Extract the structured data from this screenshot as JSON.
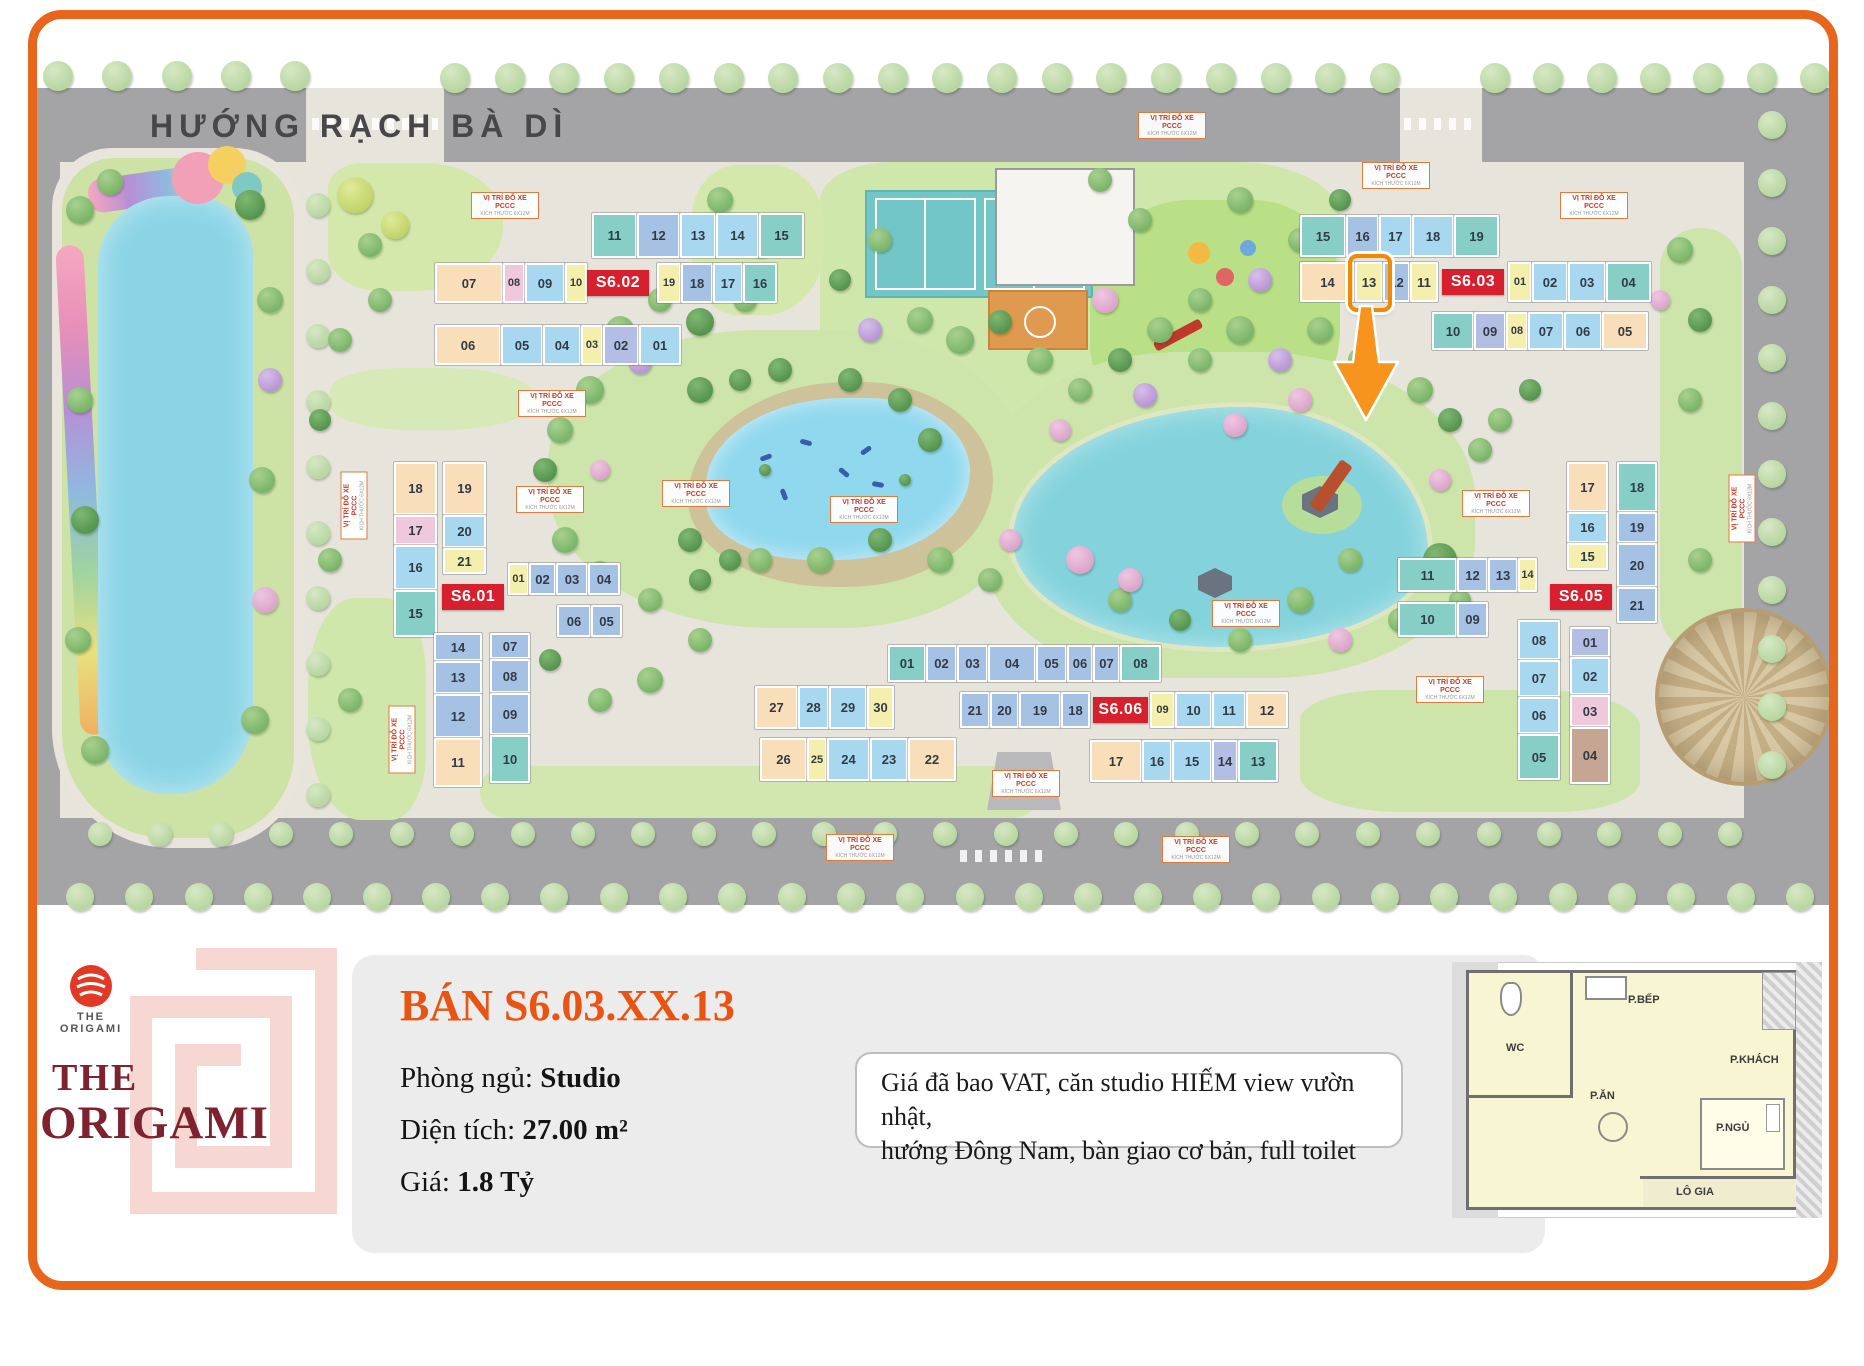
{
  "map": {
    "road_title": "HƯỚNG RẠCH BÀ DÌ",
    "pccc_label": "VỊ TRÍ ĐỖ XE PCCC",
    "pccc_sub": "KÍCH THƯỚC 6X12M",
    "unit_colors": {
      "t": "#87CFC6",
      "s": "#A8D8F0",
      "b": "#A5C1E4",
      "y": "#F5EFAD",
      "p": "#F8DFB9",
      "k": "#EFC8DB",
      "v": "#B2BEE3",
      "n": "#C7A593"
    },
    "highlight": {
      "building": "S6.03",
      "unit": "13"
    },
    "buildings": [
      {
        "label": "S6.02",
        "strips": [
          {
            "x": 592,
            "y": 213,
            "dir": "h",
            "h": 45,
            "cells": [
              {
                "n": "11",
                "c": "t",
                "w": 45
              },
              {
                "n": "12",
                "c": "b",
                "w": 43
              },
              {
                "n": "13",
                "c": "s",
                "w": 36
              },
              {
                "n": "14",
                "c": "s",
                "w": 43
              },
              {
                "n": "15",
                "c": "t",
                "w": 45
              }
            ]
          },
          {
            "x": 435,
            "y": 263,
            "dir": "h",
            "h": 40,
            "cells": [
              {
                "n": "07",
                "c": "p",
                "w": 68
              },
              {
                "n": "08",
                "c": "k",
                "w": 22
              },
              {
                "n": "09",
                "c": "s",
                "w": 40
              },
              {
                "n": "10",
                "c": "y",
                "w": 22
              },
              {
                "lab": true,
                "w": 62
              },
              {
                "n": "19",
                "c": "y",
                "w": 24,
                "g": 8
              },
              {
                "n": "18",
                "c": "b",
                "w": 32
              },
              {
                "n": "17",
                "c": "s",
                "w": 30
              },
              {
                "n": "16",
                "c": "t",
                "w": 34
              }
            ]
          },
          {
            "x": 435,
            "y": 325,
            "dir": "h",
            "h": 40,
            "cells": [
              {
                "n": "06",
                "c": "p",
                "w": 66
              },
              {
                "n": "05",
                "c": "s",
                "w": 42
              },
              {
                "n": "04",
                "c": "s",
                "w": 38
              },
              {
                "n": "03",
                "c": "y",
                "w": 22
              },
              {
                "n": "02",
                "c": "v",
                "w": 36
              },
              {
                "n": "01",
                "c": "s",
                "w": 42
              }
            ]
          }
        ]
      },
      {
        "label": "S6.03",
        "strips": [
          {
            "x": 1300,
            "y": 215,
            "dir": "h",
            "h": 42,
            "cells": [
              {
                "n": "15",
                "c": "t",
                "w": 46
              },
              {
                "n": "16",
                "c": "b",
                "w": 33
              },
              {
                "n": "17",
                "c": "s",
                "w": 33
              },
              {
                "n": "18",
                "c": "s",
                "w": 42
              },
              {
                "n": "19",
                "c": "t",
                "w": 45
              }
            ]
          },
          {
            "x": 1300,
            "y": 262,
            "dir": "h",
            "h": 40,
            "cells": [
              {
                "n": "14",
                "c": "p",
                "w": 55
              },
              {
                "n": "13",
                "c": "y",
                "w": 28,
                "hl": true
              },
              {
                "n": "12",
                "c": "b",
                "w": 27
              },
              {
                "n": "11",
                "c": "y",
                "w": 28
              },
              {
                "lab": true,
                "w": 62,
                "g": 4
              },
              {
                "n": "01",
                "c": "y",
                "w": 24,
                "g": 4
              },
              {
                "n": "02",
                "c": "s",
                "w": 36
              },
              {
                "n": "03",
                "c": "s",
                "w": 38
              },
              {
                "n": "04",
                "c": "t",
                "w": 45
              }
            ]
          },
          {
            "x": 1432,
            "y": 312,
            "dir": "h",
            "h": 38,
            "cells": [
              {
                "n": "10",
                "c": "t",
                "w": 42
              },
              {
                "n": "09",
                "c": "v",
                "w": 32
              },
              {
                "n": "08",
                "c": "y",
                "w": 22
              },
              {
                "n": "07",
                "c": "s",
                "w": 36
              },
              {
                "n": "06",
                "c": "s",
                "w": 38
              },
              {
                "n": "05",
                "c": "p",
                "w": 46
              }
            ]
          }
        ]
      },
      {
        "label": "S6.01",
        "strips": [
          {
            "x": 394,
            "y": 462,
            "dir": "v",
            "w": 43,
            "cells": [
              {
                "n": "18",
                "c": "p",
                "h": 53
              },
              {
                "n": "17",
                "c": "k",
                "h": 30
              },
              {
                "n": "16",
                "c": "s",
                "h": 45
              },
              {
                "n": "15",
                "c": "t",
                "h": 47
              }
            ]
          },
          {
            "x": 443,
            "y": 462,
            "dir": "v",
            "w": 43,
            "cells": [
              {
                "n": "19",
                "c": "p",
                "h": 53
              },
              {
                "n": "20",
                "c": "s",
                "h": 33
              },
              {
                "n": "21",
                "c": "y",
                "h": 26
              }
            ]
          },
          {
            "x": 442,
            "y": 584,
            "dir": "h",
            "h": 26,
            "cells": [
              {
                "lab": true,
                "w": 62
              }
            ]
          },
          {
            "x": 508,
            "y": 563,
            "dir": "h",
            "h": 32,
            "cells": [
              {
                "n": "01",
                "c": "y",
                "w": 21
              },
              {
                "n": "02",
                "c": "b",
                "w": 27
              },
              {
                "n": "03",
                "c": "b",
                "w": 32
              },
              {
                "n": "04",
                "c": "b",
                "w": 32
              }
            ]
          },
          {
            "x": 557,
            "y": 605,
            "dir": "h",
            "h": 32,
            "cells": [
              {
                "n": "06",
                "c": "b",
                "w": 34
              },
              {
                "n": "05",
                "c": "b",
                "w": 31
              }
            ]
          },
          {
            "x": 434,
            "y": 633,
            "dir": "v",
            "w": 48,
            "cells": [
              {
                "n": "14",
                "c": "b",
                "h": 28
              },
              {
                "n": "13",
                "c": "b",
                "h": 33
              },
              {
                "n": "12",
                "c": "b",
                "h": 44
              },
              {
                "n": "11",
                "c": "p",
                "h": 49
              }
            ]
          },
          {
            "x": 490,
            "y": 633,
            "dir": "v",
            "w": 40,
            "cells": [
              {
                "n": "07",
                "c": "b",
                "h": 26
              },
              {
                "n": "08",
                "c": "b",
                "h": 34
              },
              {
                "n": "09",
                "c": "b",
                "h": 42
              },
              {
                "n": "10",
                "c": "t",
                "h": 48
              }
            ]
          }
        ]
      },
      {
        "label": "S6.05",
        "strips": [
          {
            "x": 1398,
            "y": 558,
            "dir": "h",
            "h": 34,
            "cells": [
              {
                "n": "11",
                "c": "t",
                "w": 59
              },
              {
                "n": "12",
                "c": "b",
                "w": 31
              },
              {
                "n": "13",
                "c": "b",
                "w": 30
              },
              {
                "n": "14",
                "c": "y",
                "w": 19
              }
            ]
          },
          {
            "x": 1398,
            "y": 602,
            "dir": "h",
            "h": 35,
            "cells": [
              {
                "n": "10",
                "c": "t",
                "w": 59
              },
              {
                "n": "09",
                "c": "b",
                "w": 31
              }
            ]
          },
          {
            "x": 1567,
            "y": 462,
            "dir": "v",
            "w": 41,
            "cells": [
              {
                "n": "17",
                "c": "p",
                "h": 50
              },
              {
                "n": "16",
                "c": "s",
                "h": 31
              },
              {
                "n": "15",
                "c": "y",
                "h": 27
              }
            ]
          },
          {
            "x": 1617,
            "y": 462,
            "dir": "v",
            "w": 40,
            "cells": [
              {
                "n": "18",
                "c": "t",
                "h": 50
              },
              {
                "n": "19",
                "c": "b",
                "h": 31
              },
              {
                "n": "20",
                "c": "b",
                "h": 44
              },
              {
                "n": "21",
                "c": "b",
                "h": 36
              }
            ]
          },
          {
            "x": 1550,
            "y": 584,
            "dir": "h",
            "h": 26,
            "cells": [
              {
                "lab": true,
                "w": 62
              }
            ]
          },
          {
            "x": 1518,
            "y": 620,
            "dir": "v",
            "w": 42,
            "cells": [
              {
                "n": "08",
                "c": "s",
                "h": 40
              },
              {
                "n": "07",
                "c": "s",
                "h": 37
              },
              {
                "n": "06",
                "c": "s",
                "h": 37
              },
              {
                "n": "05",
                "c": "t",
                "h": 46
              }
            ]
          },
          {
            "x": 1570,
            "y": 627,
            "dir": "v",
            "w": 40,
            "cells": [
              {
                "n": "01",
                "c": "v",
                "h": 30
              },
              {
                "n": "02",
                "c": "s",
                "h": 38
              },
              {
                "n": "03",
                "c": "k",
                "h": 32
              },
              {
                "n": "04",
                "c": "n",
                "h": 57
              }
            ]
          }
        ]
      },
      {
        "label": "S6.06",
        "strips": [
          {
            "x": 888,
            "y": 645,
            "dir": "h",
            "h": 37,
            "cells": [
              {
                "n": "01",
                "c": "t",
                "w": 38
              },
              {
                "n": "02",
                "c": "b",
                "w": 31
              },
              {
                "n": "03",
                "c": "b",
                "w": 31
              },
              {
                "n": "04",
                "c": "b",
                "w": 48
              },
              {
                "n": "05",
                "c": "b",
                "w": 31
              },
              {
                "n": "06",
                "c": "b",
                "w": 26
              },
              {
                "n": "07",
                "c": "b",
                "w": 27
              },
              {
                "n": "08",
                "c": "t",
                "w": 41
              }
            ]
          },
          {
            "x": 755,
            "y": 686,
            "dir": "h",
            "h": 43,
            "cells": [
              {
                "n": "27",
                "c": "p",
                "w": 43
              },
              {
                "n": "28",
                "c": "s",
                "w": 31
              },
              {
                "n": "29",
                "c": "s",
                "w": 38
              },
              {
                "n": "30",
                "c": "y",
                "w": 27
              }
            ]
          },
          {
            "x": 960,
            "y": 692,
            "dir": "h",
            "h": 36,
            "cells": [
              {
                "n": "21",
                "c": "b",
                "w": 30
              },
              {
                "n": "20",
                "c": "b",
                "w": 29
              },
              {
                "n": "19",
                "c": "b",
                "w": 42
              },
              {
                "n": "18",
                "c": "b",
                "w": 29
              },
              {
                "lab": true,
                "w": 55,
                "g": 3
              },
              {
                "n": "09",
                "c": "y",
                "w": 25,
                "g": 2
              },
              {
                "n": "10",
                "c": "s",
                "w": 37
              },
              {
                "n": "11",
                "c": "s",
                "w": 34
              },
              {
                "n": "12",
                "c": "p",
                "w": 42
              }
            ]
          },
          {
            "x": 760,
            "y": 738,
            "dir": "h",
            "h": 43,
            "cells": [
              {
                "n": "26",
                "c": "p",
                "w": 47
              },
              {
                "n": "25",
                "c": "y",
                "w": 20
              },
              {
                "n": "24",
                "c": "s",
                "w": 43
              },
              {
                "n": "23",
                "c": "s",
                "w": 38
              },
              {
                "n": "22",
                "c": "p",
                "w": 48
              }
            ]
          },
          {
            "x": 1090,
            "y": 740,
            "dir": "h",
            "h": 42,
            "cells": [
              {
                "n": "17",
                "c": "p",
                "w": 52
              },
              {
                "n": "16",
                "c": "s",
                "w": 30
              },
              {
                "n": "15",
                "c": "s",
                "w": 40
              },
              {
                "n": "14",
                "c": "v",
                "w": 26
              },
              {
                "n": "13",
                "c": "t",
                "w": 40
              }
            ]
          }
        ]
      }
    ]
  },
  "panel": {
    "title": "BÁN S6.03.XX.13",
    "fields": [
      {
        "label": "Phòng ngủ:",
        "value": "Studio"
      },
      {
        "label": "Diện tích:",
        "value": "27.00 m²"
      },
      {
        "label": "Giá:",
        "value": "1.8 Tỷ"
      }
    ],
    "note_line1": "Giá đã bao VAT, căn studio HIẾM view vườn nhật,",
    "note_line2": "hướng Đông Nam, bàn giao cơ bản, full toilet",
    "logo": {
      "tiny_top": "THE",
      "tiny_bottom": "ORIGAMI",
      "line1": "THE",
      "line2": "ORIGAMI"
    },
    "floorplan": {
      "rooms": [
        {
          "t": "WC",
          "x": 1506,
          "y": 1042
        },
        {
          "t": "P.BẾP",
          "x": 1628,
          "y": 994
        },
        {
          "t": "P.KHÁCH",
          "x": 1730,
          "y": 1054
        },
        {
          "t": "P.ĂN",
          "x": 1590,
          "y": 1090
        },
        {
          "t": "P.NGỦ",
          "x": 1716,
          "y": 1122
        },
        {
          "t": "LÔ GIA",
          "x": 1676,
          "y": 1186
        }
      ]
    }
  }
}
